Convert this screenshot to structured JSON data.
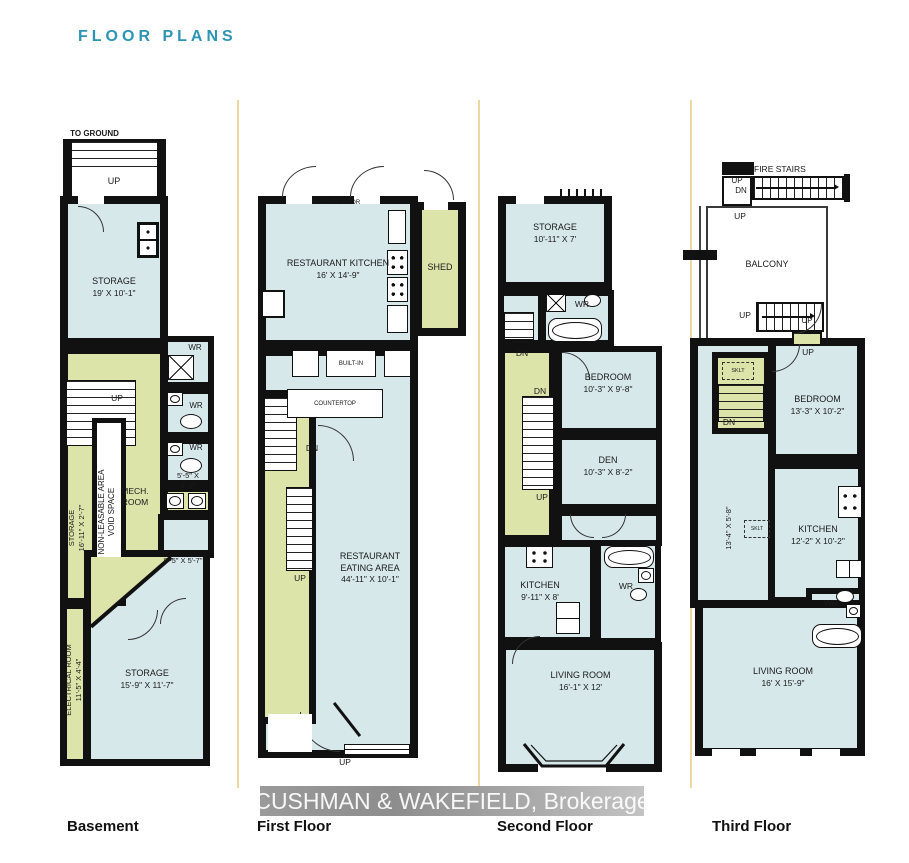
{
  "title": "FLOOR PLANS",
  "watermark": "CUSHMAN & WAKEFIELD, Brokerage",
  "colors": {
    "accent_teal": "#2d95b3",
    "room_blue": "#d7e8eb",
    "room_green": "#dde4aa",
    "wall_black": "#111111",
    "separator_tan": "#eed8a2"
  },
  "basement": {
    "label": "Basement",
    "to_ground": "TO GROUND",
    "up_top": "UP",
    "storage_top": "STORAGE",
    "storage_top_dims": "19' X 10'-1\"",
    "wr1": "WR",
    "wr2": "WR",
    "wr3": "WR",
    "up_mid": "UP",
    "non_leasable": "NON-LEASABLE AREA",
    "void_space": "VOID SPACE",
    "storage_strip": "STORAGE",
    "storage_strip_dims": "16'-11\" X 2'-7\"",
    "mech1": "MECH.",
    "mech2": "ROOM",
    "vanity_dims1": "5'-5\" X",
    "vanity_dims2": "4'-2\"",
    "nook_dims": "9'-5\" X 5'-7\"",
    "electrical": "ELECTRICAL ROOM",
    "electrical_dims": "11'-5\" X 4'-4\"",
    "storage_bottom": "STORAGE",
    "storage_bottom_dims": "15'-9\" X 11'-7\""
  },
  "first_floor": {
    "label": "First Floor",
    "blocked_door": "BLOCKED DOOR",
    "kitchen": "RESTAURANT KITCHEN",
    "kitchen_dims": "16' X 14'-9\"",
    "shed": "SHED",
    "built_in": "BUILT-IN",
    "countertop": "COUNTERTOP",
    "dn": "DN",
    "up_mid": "UP",
    "eating1": "RESTAURANT",
    "eating2": "EATING AREA",
    "eating_dims": "44'-11\" X 10'-1\"",
    "up_bottom": "UP"
  },
  "second_floor": {
    "label": "Second Floor",
    "storage": "STORAGE",
    "storage_dims": "10'-11\" X 7'",
    "wr_top": "WR",
    "dn_strip": "DN",
    "dn_stairs": "DN",
    "up_strip": "UP",
    "bedroom": "BEDROOM",
    "bedroom_dims": "10'-3\" X 9'-8\"",
    "den": "DEN",
    "den_dims": "10'-3\" X 8'-2\"",
    "kitchen": "KITCHEN",
    "kitchen_dims": "9'-11\" X 8'",
    "wr_bottom": "WR",
    "living": "LIVING ROOM",
    "living_dims": "16'-1\" X 12'"
  },
  "third_floor": {
    "label": "Third Floor",
    "fire_stairs": "FIRE STAIRS",
    "fs_up": "UP",
    "fs_dn": "DN",
    "up_below": "UP",
    "balcony": "BALCONY",
    "up_stairs": "UP",
    "up_door": "UP",
    "up_entry": "UP",
    "sklt1": "SKLT",
    "dn": "DN",
    "bedroom": "BEDROOM",
    "bedroom_dims": "13'-3\" X 10'-2\"",
    "hall_dims": "13'-4\" X 5'-8\"",
    "sklt2": "SKLT",
    "kitchen": "KITCHEN",
    "kitchen_dims": "12'-2\" X 10'-2\"",
    "wr": "WR",
    "living": "LIVING ROOM",
    "living_dims": "16' X 15'-9\""
  }
}
